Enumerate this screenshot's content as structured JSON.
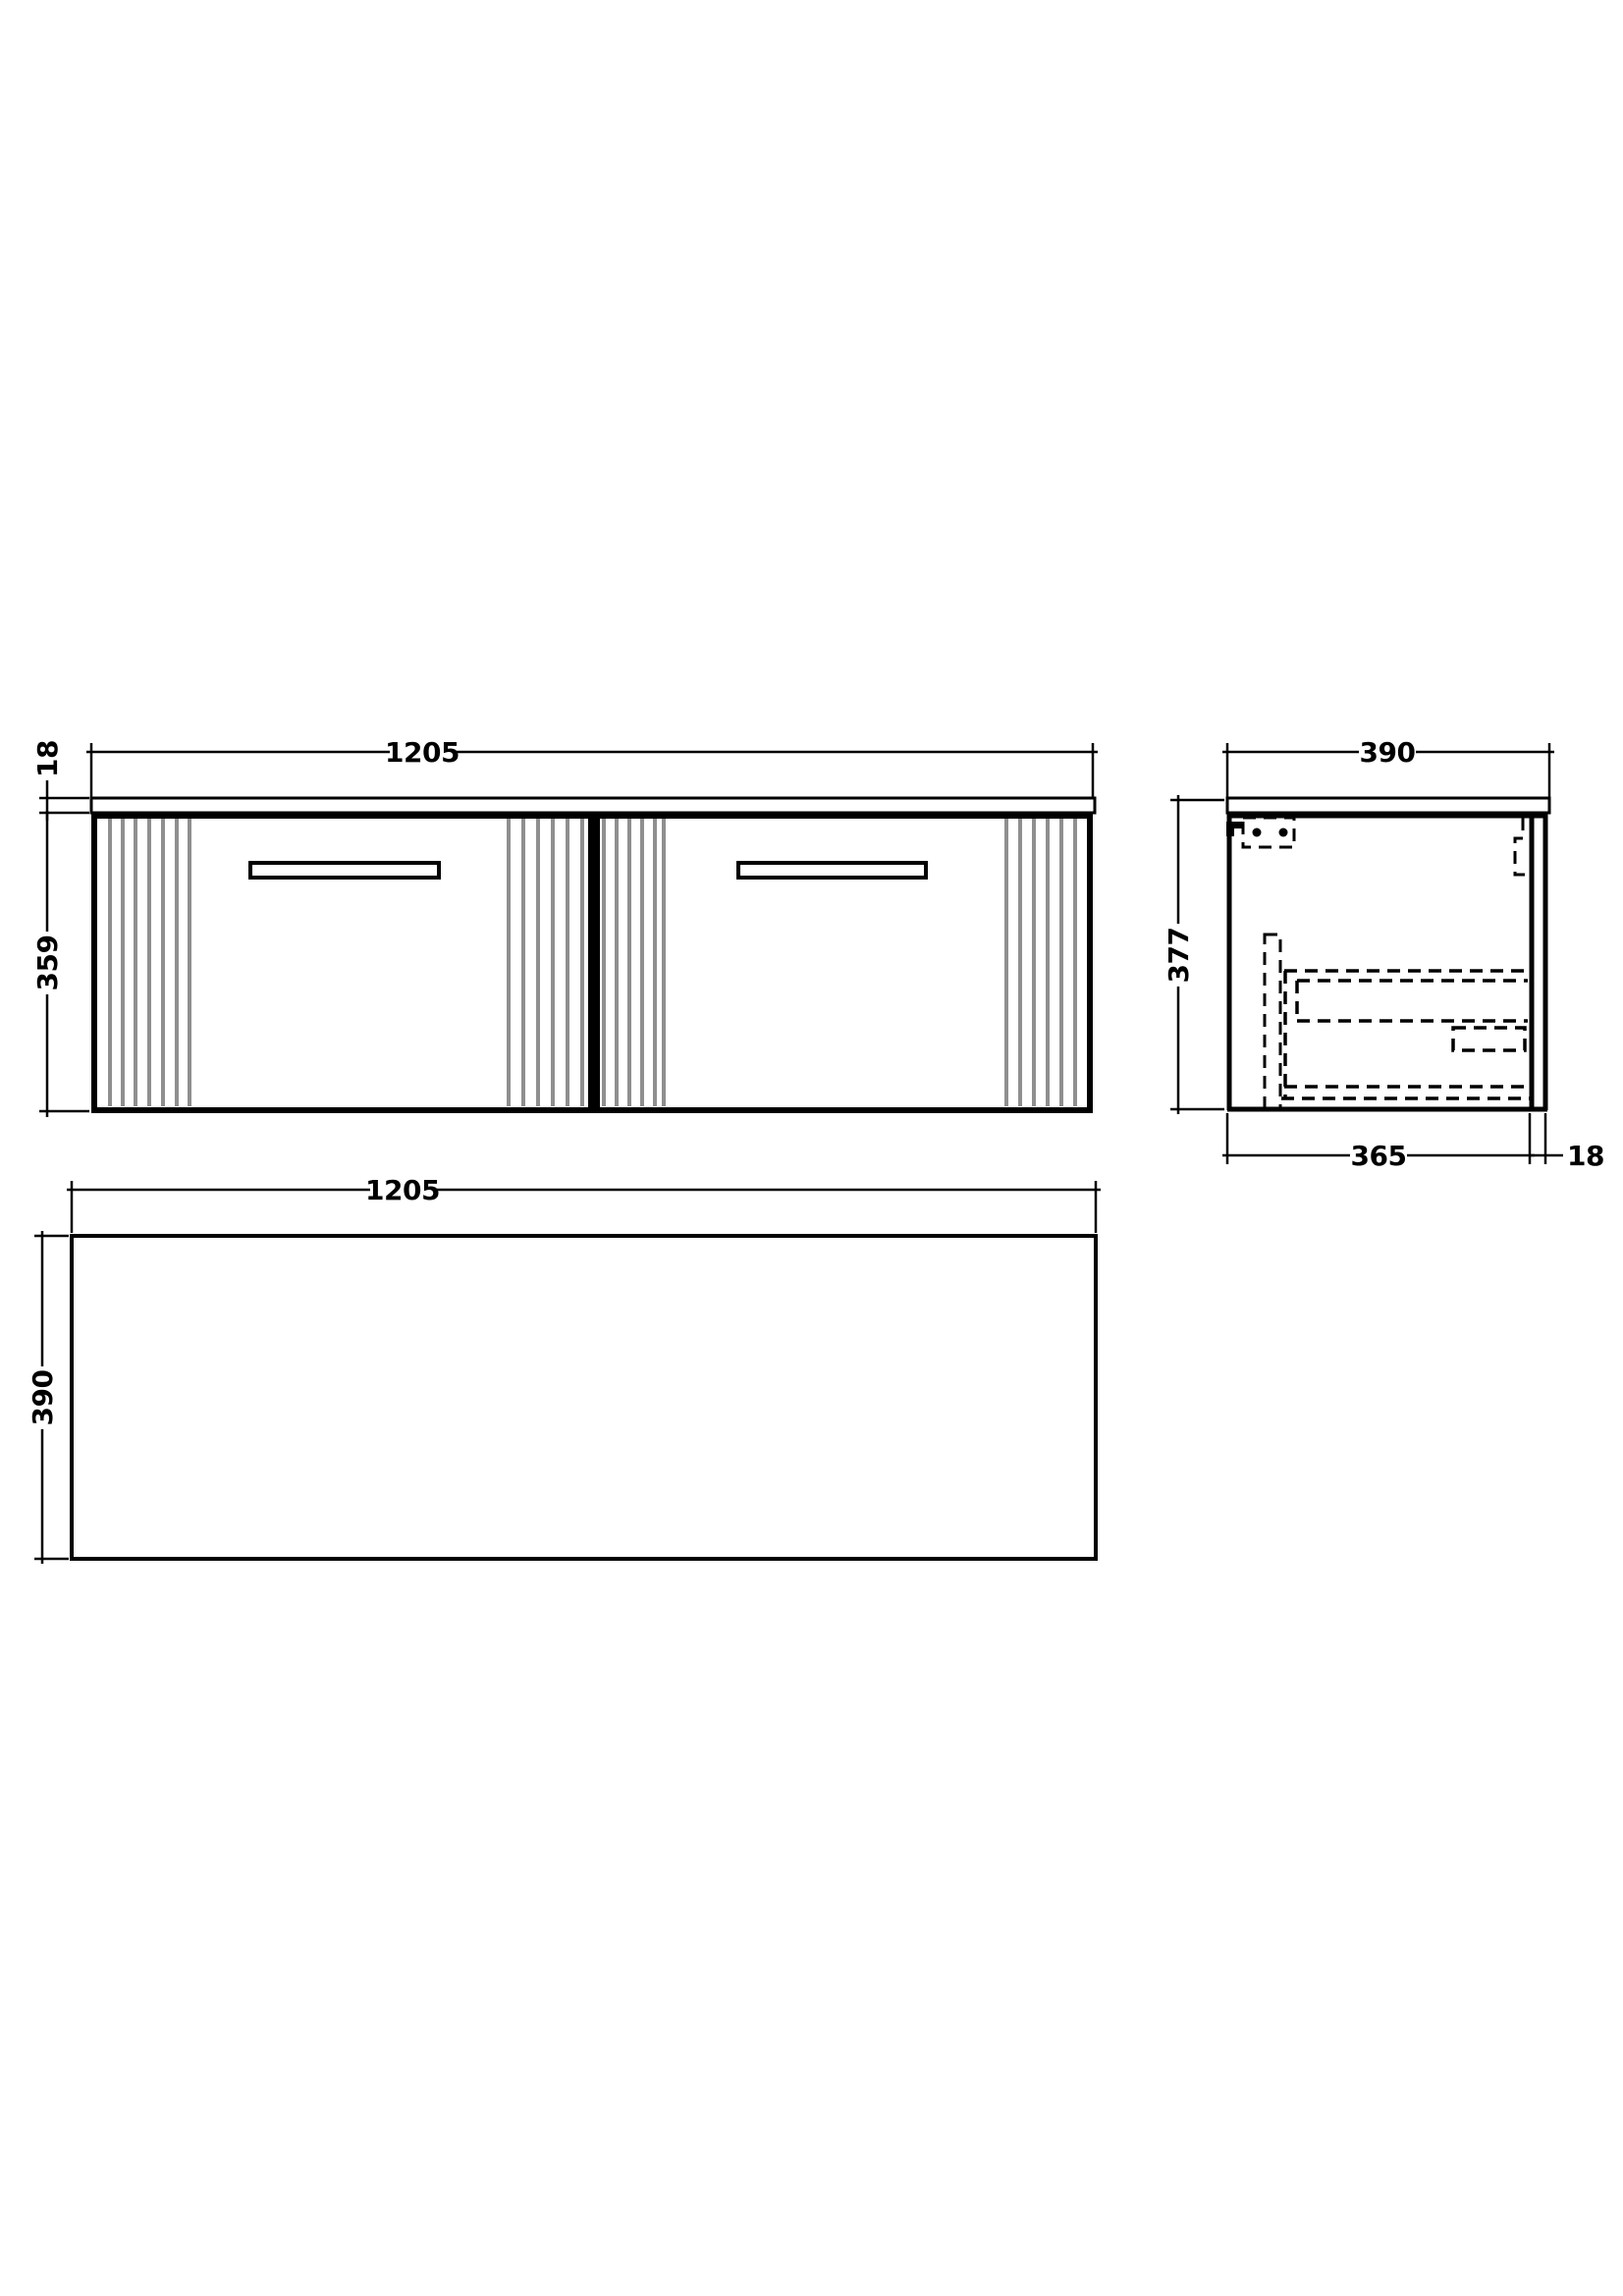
{
  "dims": {
    "front_width": "1205",
    "front_counter_thickness": "18",
    "front_body_height": "359",
    "side_depth": "390",
    "side_total_height": "377",
    "side_carcass_depth": "365",
    "side_back_thickness": "18",
    "plan_width": "1205",
    "plan_depth": "390"
  },
  "colors": {
    "line": "#000000",
    "flute": "#8f8f8f",
    "background": "#ffffff"
  }
}
